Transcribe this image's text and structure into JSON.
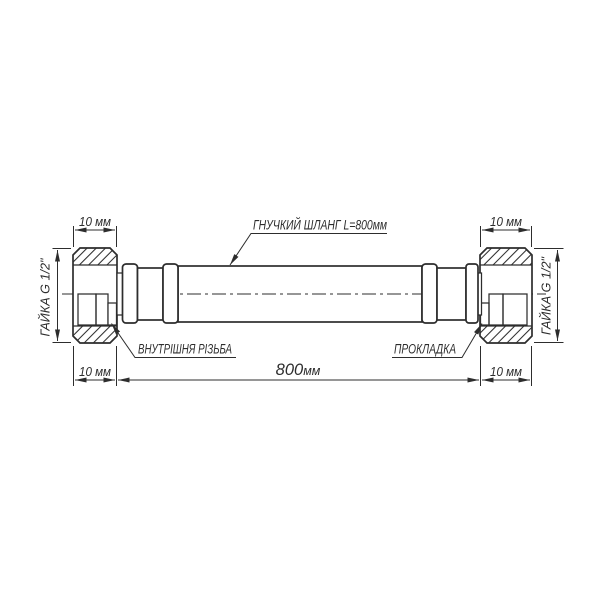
{
  "colors": {
    "line": "#2d2d2d",
    "braid_bg": "#cbcbcb",
    "braid_line": "#575757",
    "background": "#ffffff"
  },
  "labels": {
    "hose": "ГНУЧКИЙ ШЛАНГ L=800мм",
    "internal_thread": "ВНУТРІШНЯ РІЗЬБА",
    "gasket": "ПРОКЛАДКА",
    "nut_left": "ГАЙКА G 1/2\"",
    "nut_right": "ГАЙКА G 1/2\""
  },
  "dimensions": {
    "nut_width_top_left": "10 мм",
    "nut_width_top_right": "10 мм",
    "nut_width_bottom_left": "10 мм",
    "nut_width_bottom_right": "10 мм",
    "hose_length_value": "800",
    "hose_length_unit": "мм"
  }
}
